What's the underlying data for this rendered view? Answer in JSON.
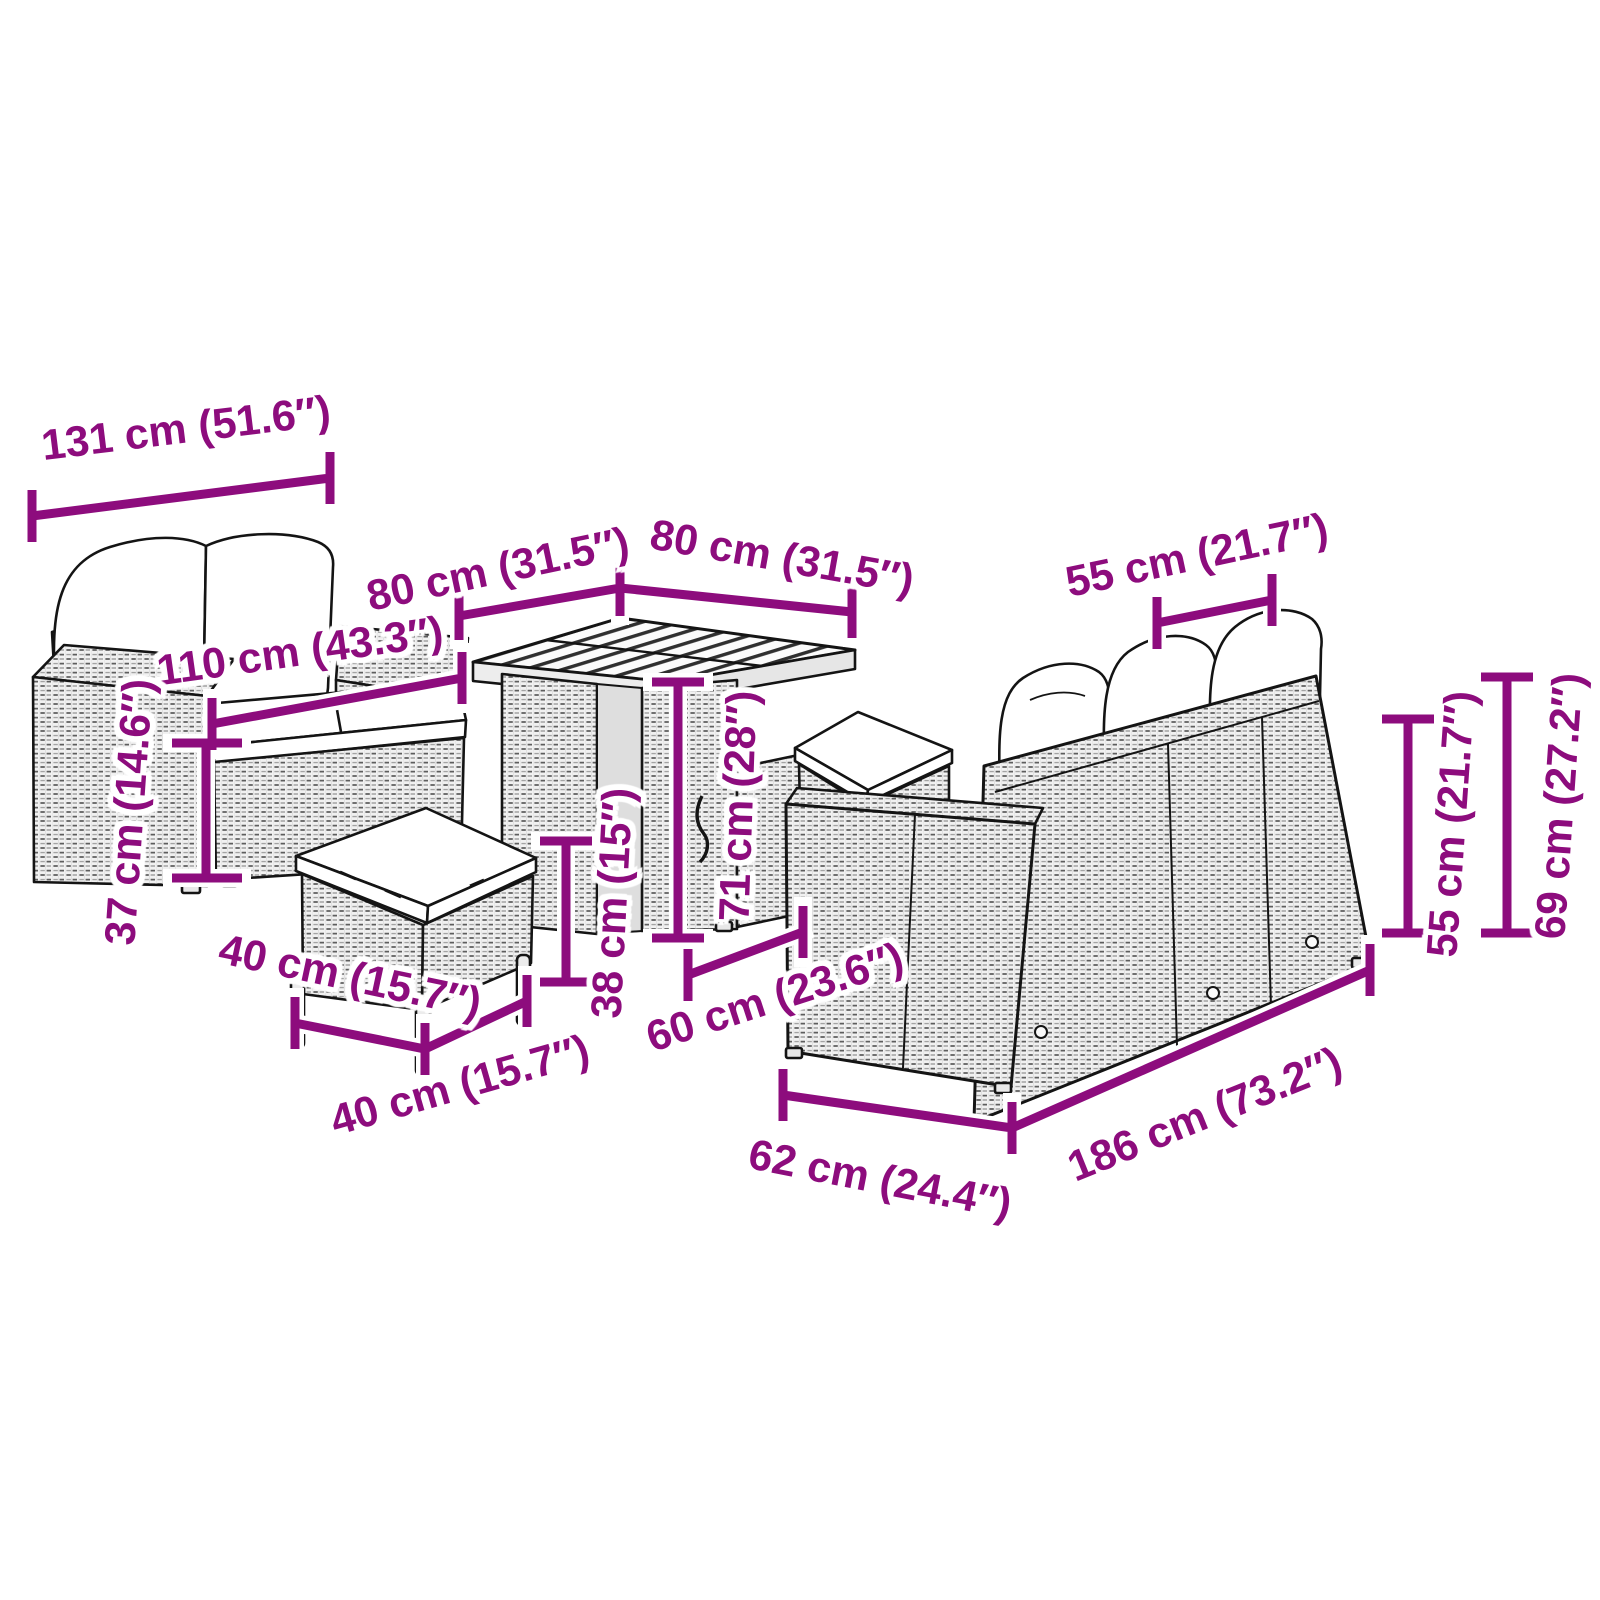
{
  "page": {
    "background_color": "#ffffff",
    "canvas_size_px": 1600
  },
  "diagram": {
    "style": {
      "accent_color": "#8d0c7d",
      "art_color": "#141414",
      "halo_color": "#ffffff"
    },
    "annotations": [
      {
        "id": "sofa-2s-overall-width",
        "text": "131 cm (51.6″)",
        "cm": 131,
        "in": 51.6
      },
      {
        "id": "table-top-depth",
        "text": "80 cm (31.5″)",
        "cm": 80,
        "in": 31.5
      },
      {
        "id": "table-top-width",
        "text": "80 cm (31.5″)",
        "cm": 80,
        "in": 31.5
      },
      {
        "id": "sofa-2s-seat-width",
        "text": "110 cm (43.3″)",
        "cm": 110,
        "in": 43.3
      },
      {
        "id": "sofa-3s-seat-section-width",
        "text": "55 cm (21.7″)",
        "cm": 55,
        "in": 21.7
      },
      {
        "id": "sofa-2s-seat-height",
        "text": "37 cm (14.6″)",
        "cm": 37,
        "in": 14.6
      },
      {
        "id": "stool-depth",
        "text": "40 cm (15.7″)",
        "cm": 40,
        "in": 15.7
      },
      {
        "id": "stool-width",
        "text": "40 cm (15.7″)",
        "cm": 40,
        "in": 15.7
      },
      {
        "id": "stool-height",
        "text": "38 cm (15″)",
        "cm": 38,
        "in": 15
      },
      {
        "id": "table-height",
        "text": "71 cm (28″)",
        "cm": 71,
        "in": 28
      },
      {
        "id": "sofa-3s-seat-depth",
        "text": "60 cm (23.6″)",
        "cm": 60,
        "in": 23.6
      },
      {
        "id": "sofa-3s-end-depth",
        "text": "62 cm (24.4″)",
        "cm": 62,
        "in": 24.4
      },
      {
        "id": "sofa-3s-length",
        "text": "186 cm (73.2″)",
        "cm": 186,
        "in": 73.2
      },
      {
        "id": "sofa-3s-back-height",
        "text": "55 cm (21.7″)",
        "cm": 55,
        "in": 21.7
      },
      {
        "id": "sofa-3s-total-height",
        "text": "69 cm (27.2″)",
        "cm": 69,
        "in": 27.2
      }
    ]
  }
}
